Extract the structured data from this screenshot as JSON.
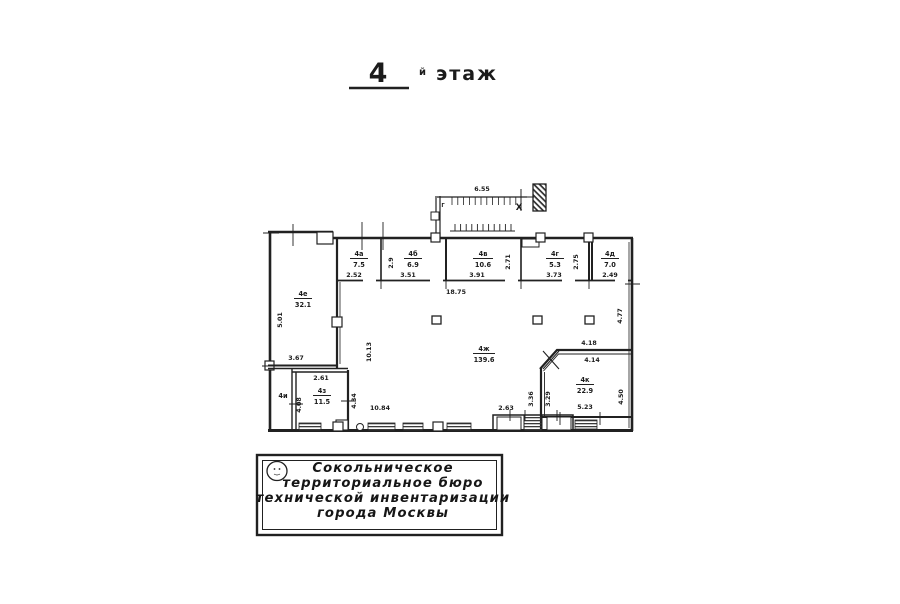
{
  "title": {
    "number": "4",
    "suffix": "й",
    "word": "этаж"
  },
  "plan": {
    "balcony": {
      "length": "6.55",
      "cross_mark": "X",
      "corner_mark": "Г"
    },
    "top_rooms": [
      {
        "id": "4а",
        "area": "7.5",
        "width": "2.52",
        "depth": "2.9"
      },
      {
        "id": "4б",
        "area": "6.9",
        "width": "3.51"
      },
      {
        "id": "4в",
        "area": "10.6",
        "width": "3.91",
        "depth": "2.71"
      },
      {
        "id": "4г",
        "area": "5.3",
        "width": "3.73",
        "depth": "2.75"
      },
      {
        "id": "4д",
        "area": "7.0",
        "width": "2.49"
      }
    ],
    "left_room": {
      "id": "4е",
      "area": "32.1",
      "left": "5.01",
      "bottom": "3.67"
    },
    "hall": {
      "id": "4ж",
      "area": "139.6",
      "top": "18.75",
      "left": "10.13",
      "bottom": "10.84",
      "right": "4.77",
      "door": "2.63"
    },
    "small_room": {
      "id": "4з",
      "area": "11.5",
      "top": "2.61",
      "left": "4.08",
      "right": "4.34"
    },
    "narrow_room": {
      "id": "4и"
    },
    "corner_room": {
      "id": "4к",
      "area": "22.9",
      "top": "4.18",
      "inner_top": "4.14",
      "bottom": "5.23",
      "right": "4.50",
      "left_outer": "3.36",
      "left_inner": "3.29"
    }
  },
  "stamp": {
    "lines": [
      "Сокольническое",
      "территориальное бюро",
      "технической инвентаризации",
      "города Москвы"
    ]
  }
}
